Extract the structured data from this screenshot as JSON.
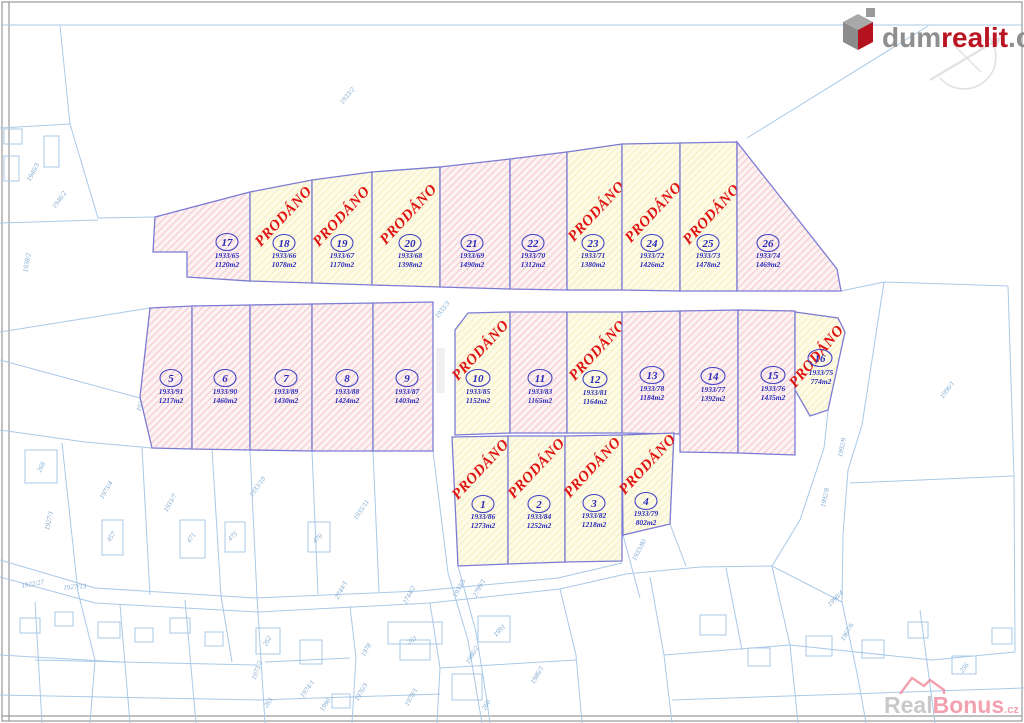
{
  "sold_label": "PRODÁNO",
  "watermark": {
    "text": "dumrealit"
  },
  "logo": {
    "dum": "dum",
    "realit": "realit",
    "cz": ".cz"
  },
  "realbonus": {
    "real": "Real",
    "bonus": "Bonus",
    "cz": ".cz"
  },
  "colors": {
    "sold_red": "#e01212",
    "plot_border": "#7b7bd4",
    "pink_fill": "#fceded",
    "yellow_fill": "#fdfbe2",
    "cadastral_blue": "#a9c9e7",
    "label_blue": "#2a2ab8",
    "brand_red": "#ba1522",
    "brand_gray": "#8e8e8e"
  },
  "plots": [
    {
      "number": "1",
      "parcel": "1933/86",
      "area": "1273m2",
      "sold": true
    },
    {
      "number": "2",
      "parcel": "1933/84",
      "area": "1252m2",
      "sold": true
    },
    {
      "number": "3",
      "parcel": "1933/82",
      "area": "1218m2",
      "sold": true
    },
    {
      "number": "4",
      "parcel": "1933/79",
      "area": "802m2",
      "sold": true
    },
    {
      "number": "5",
      "parcel": "1933/91",
      "area": "1217m2",
      "sold": false
    },
    {
      "number": "6",
      "parcel": "1933/90",
      "area": "1460m2",
      "sold": false
    },
    {
      "number": "7",
      "parcel": "1933/89",
      "area": "1430m2",
      "sold": false
    },
    {
      "number": "8",
      "parcel": "1933/88",
      "area": "1424m2",
      "sold": false
    },
    {
      "number": "9",
      "parcel": "1933/87",
      "area": "1403m2",
      "sold": false
    },
    {
      "number": "10",
      "parcel": "1933/85",
      "area": "1152m2",
      "sold": true
    },
    {
      "number": "11",
      "parcel": "1933/83",
      "area": "1165m2",
      "sold": false
    },
    {
      "number": "12",
      "parcel": "1933/81",
      "area": "1164m2",
      "sold": true
    },
    {
      "number": "13",
      "parcel": "1933/78",
      "area": "1184m2",
      "sold": false
    },
    {
      "number": "14",
      "parcel": "1933/77",
      "area": "1392m2",
      "sold": false
    },
    {
      "number": "15",
      "parcel": "1933/76",
      "area": "1435m2",
      "sold": false
    },
    {
      "number": "16",
      "parcel": "1933/75",
      "area": "774m2",
      "sold": true
    },
    {
      "number": "17",
      "parcel": "1933/65",
      "area": "1120m2",
      "sold": false
    },
    {
      "number": "18",
      "parcel": "1933/66",
      "area": "1078m2",
      "sold": true
    },
    {
      "number": "19",
      "parcel": "1933/67",
      "area": "1170m2",
      "sold": true
    },
    {
      "number": "20",
      "parcel": "1933/68",
      "area": "1398m2",
      "sold": true
    },
    {
      "number": "21",
      "parcel": "1933/69",
      "area": "1490m2",
      "sold": false
    },
    {
      "number": "22",
      "parcel": "1933/70",
      "area": "1312m2",
      "sold": false
    },
    {
      "number": "23",
      "parcel": "1933/71",
      "area": "1380m2",
      "sold": true
    },
    {
      "number": "24",
      "parcel": "1933/72",
      "area": "1426m2",
      "sold": true
    },
    {
      "number": "25",
      "parcel": "1933/73",
      "area": "1478m2",
      "sold": true
    },
    {
      "number": "26",
      "parcel": "1933/74",
      "area": "1469m2",
      "sold": false
    }
  ],
  "bg_labels": [
    {
      "text": "1933/2"
    },
    {
      "text": "1946/3"
    },
    {
      "text": "1946/2"
    },
    {
      "text": "1938/2"
    },
    {
      "text": "1933/92"
    },
    {
      "text": "1933/3"
    },
    {
      "text": "268"
    },
    {
      "text": "1927/1"
    },
    {
      "text": "1973/4"
    },
    {
      "text": "457"
    },
    {
      "text": "1933/7"
    },
    {
      "text": "471"
    },
    {
      "text": "1933/10"
    },
    {
      "text": "475"
    },
    {
      "text": "470"
    },
    {
      "text": "1935/11"
    },
    {
      "text": "1922/27"
    },
    {
      "text": "1927/13"
    },
    {
      "text": "2744/1"
    },
    {
      "text": "2744/2"
    },
    {
      "text": "1933/5"
    },
    {
      "text": "2799/1"
    },
    {
      "text": "1933/80"
    },
    {
      "text": "262"
    },
    {
      "text": "1978"
    },
    {
      "text": "261"
    },
    {
      "text": "1973/2"
    },
    {
      "text": "1974/1"
    },
    {
      "text": "1990"
    },
    {
      "text": "1976/3"
    },
    {
      "text": "1978/1"
    },
    {
      "text": "263"
    },
    {
      "text": "260"
    },
    {
      "text": "1986/2"
    },
    {
      "text": "1991"
    },
    {
      "text": "1986/1"
    },
    {
      "text": "1996/1"
    },
    {
      "text": "1992/9"
    },
    {
      "text": "1992/8"
    },
    {
      "text": "1990/4"
    },
    {
      "text": "1967/6"
    },
    {
      "text": "256"
    }
  ]
}
